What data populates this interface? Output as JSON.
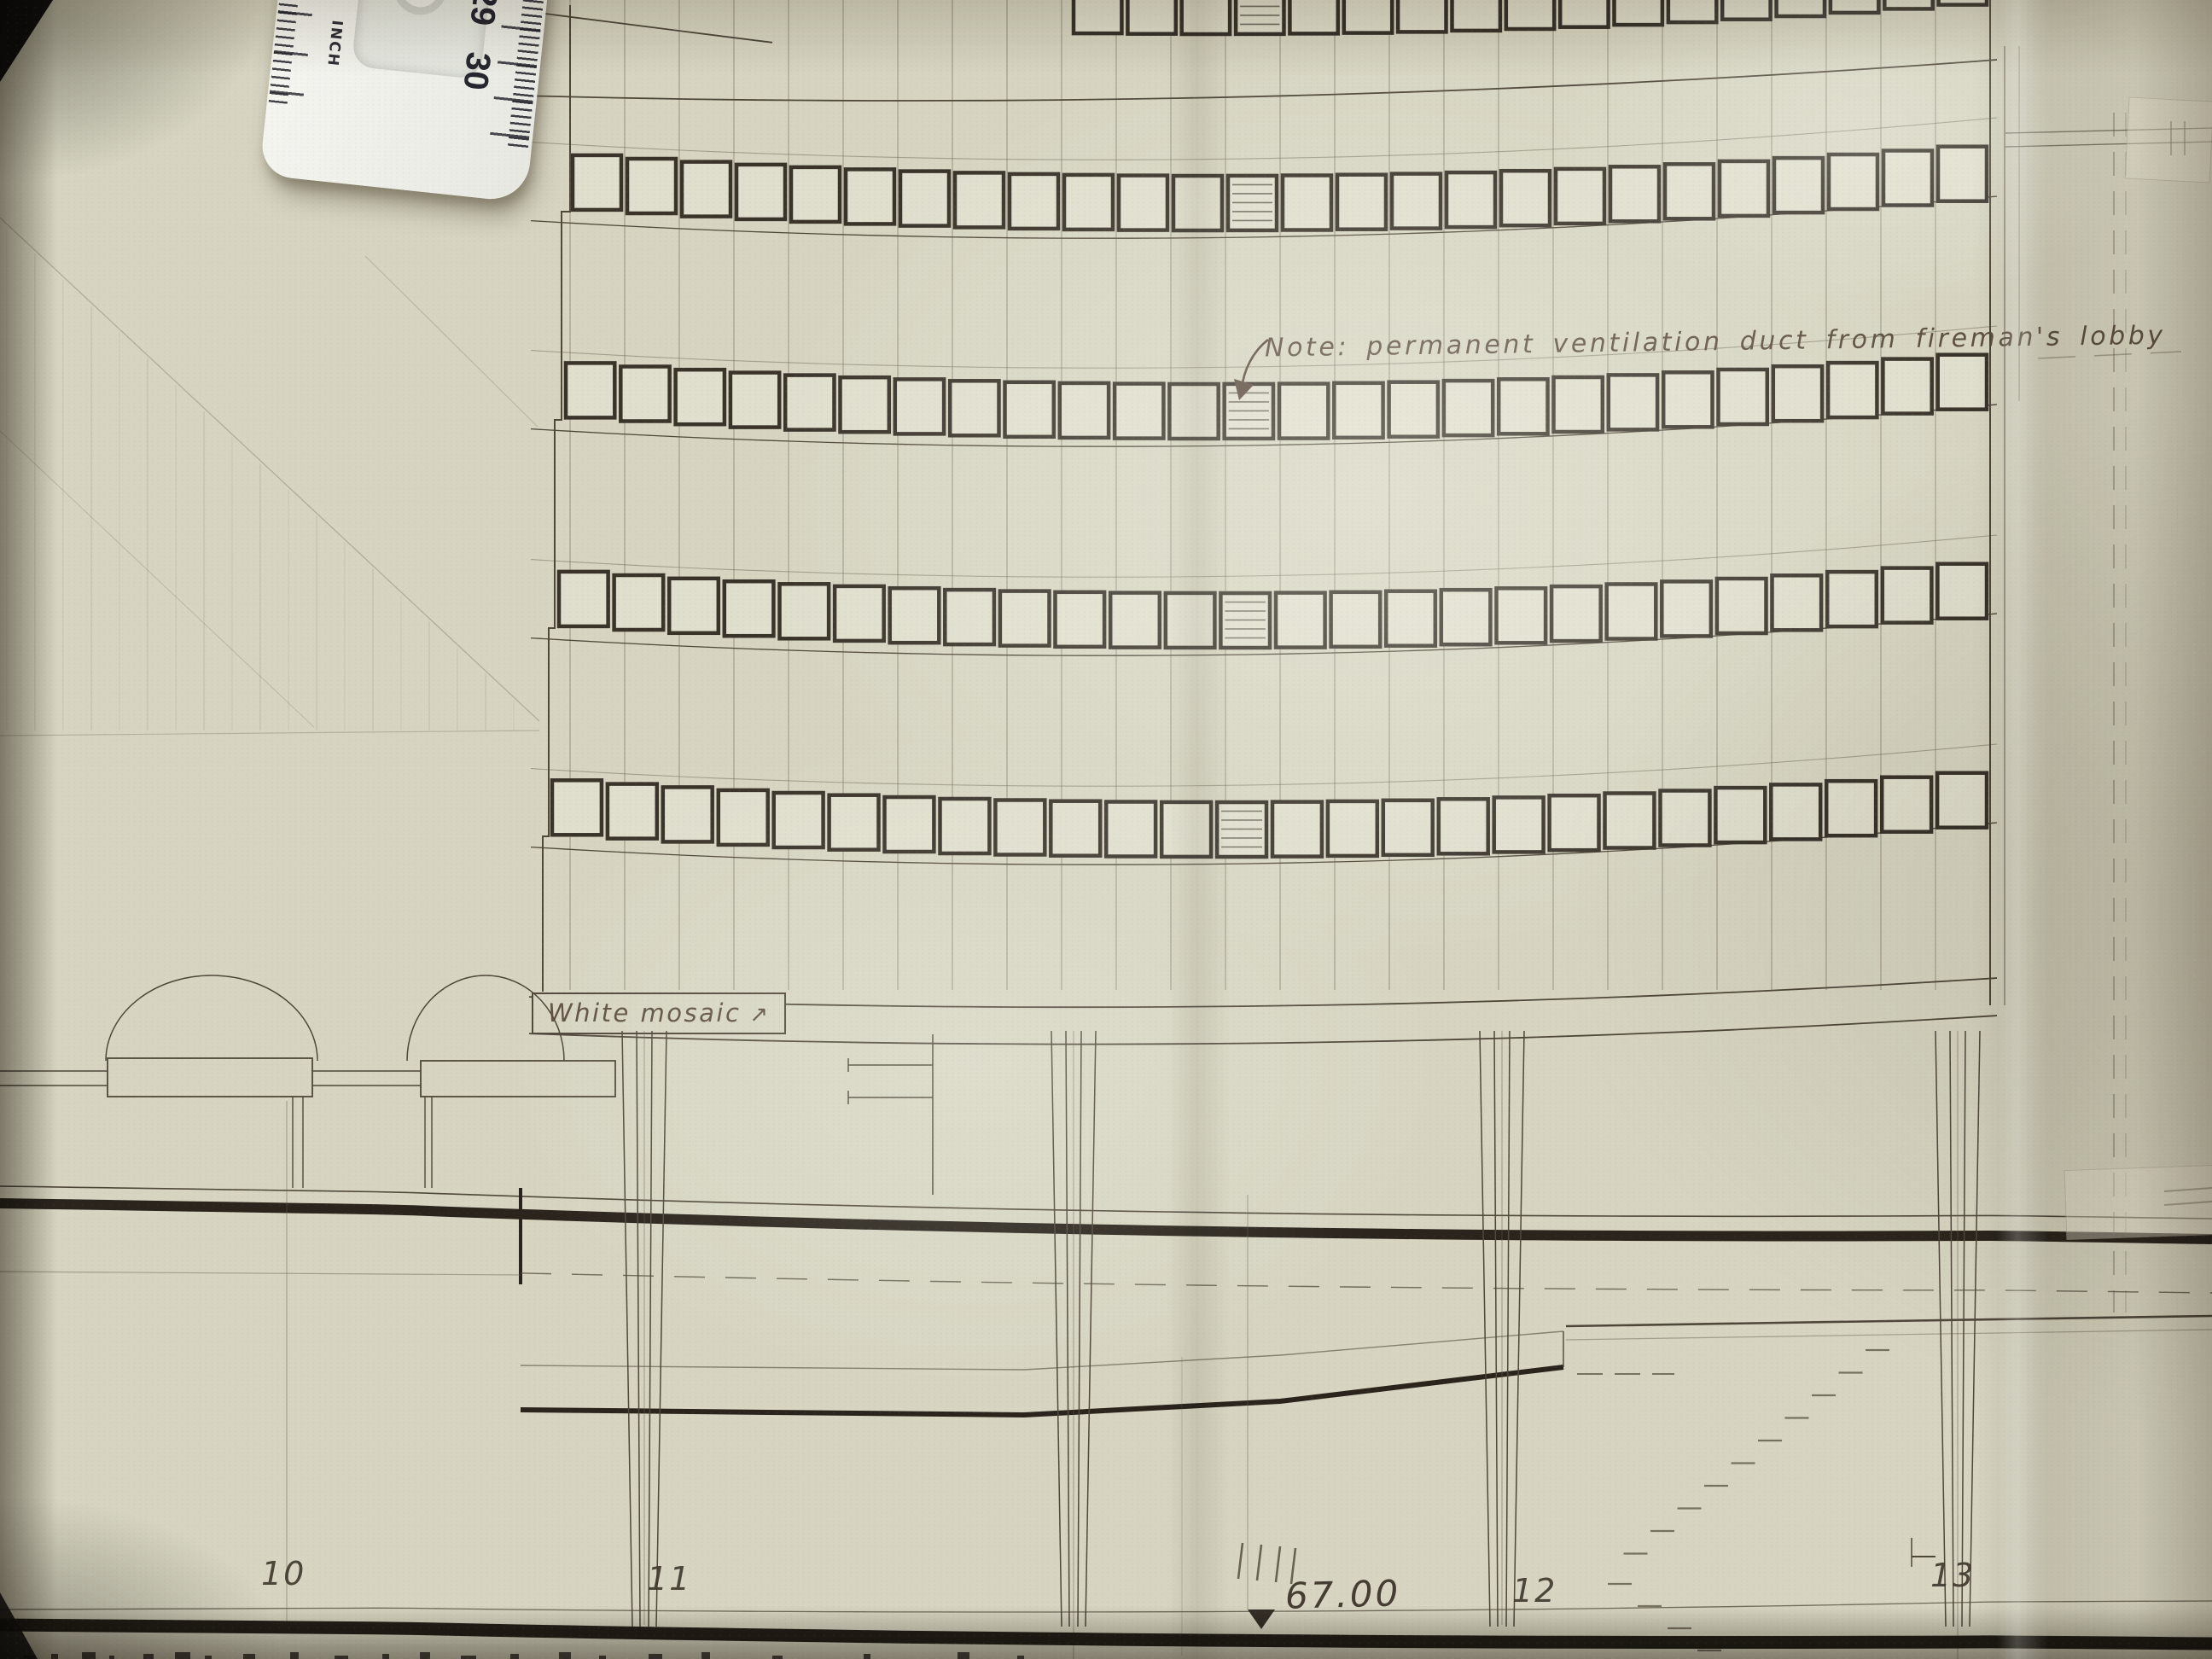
{
  "annotations": {
    "ventilation_note": "Note: permanent ventilation duct from fireman's lobby",
    "mosaic_label": "White mosaic",
    "mosaic_arrow": "↗",
    "level_value": "67.00",
    "grid_labels": [
      "10",
      "11",
      "12",
      "13"
    ]
  },
  "ruler": {
    "unit_label": "INCH",
    "scale_numbers": [
      "8",
      "29",
      "30"
    ]
  },
  "facade": {
    "bay_count": 26,
    "window_bands": [
      {
        "id": "roof-band",
        "window_count": 17,
        "louvred_indices": [
          3
        ]
      },
      {
        "id": "band-1",
        "window_count": 26,
        "louvred_indices": [
          12
        ]
      },
      {
        "id": "band-2",
        "window_count": 26,
        "louvred_indices": [
          12
        ]
      },
      {
        "id": "band-3",
        "window_count": 26,
        "louvred_indices": [
          12
        ]
      },
      {
        "id": "band-4",
        "window_count": 26,
        "louvred_indices": [
          12
        ]
      }
    ],
    "pier_count": 4,
    "arch_count": 2,
    "stair_flight_count": 2
  },
  "colors": {
    "paper": "#d7d5c2",
    "ink": "#4f473a",
    "heavy_ink": "#2a241c",
    "pencil": "#8f8774",
    "annotation_ink": "#574a3c",
    "glass": "#e0decd"
  }
}
